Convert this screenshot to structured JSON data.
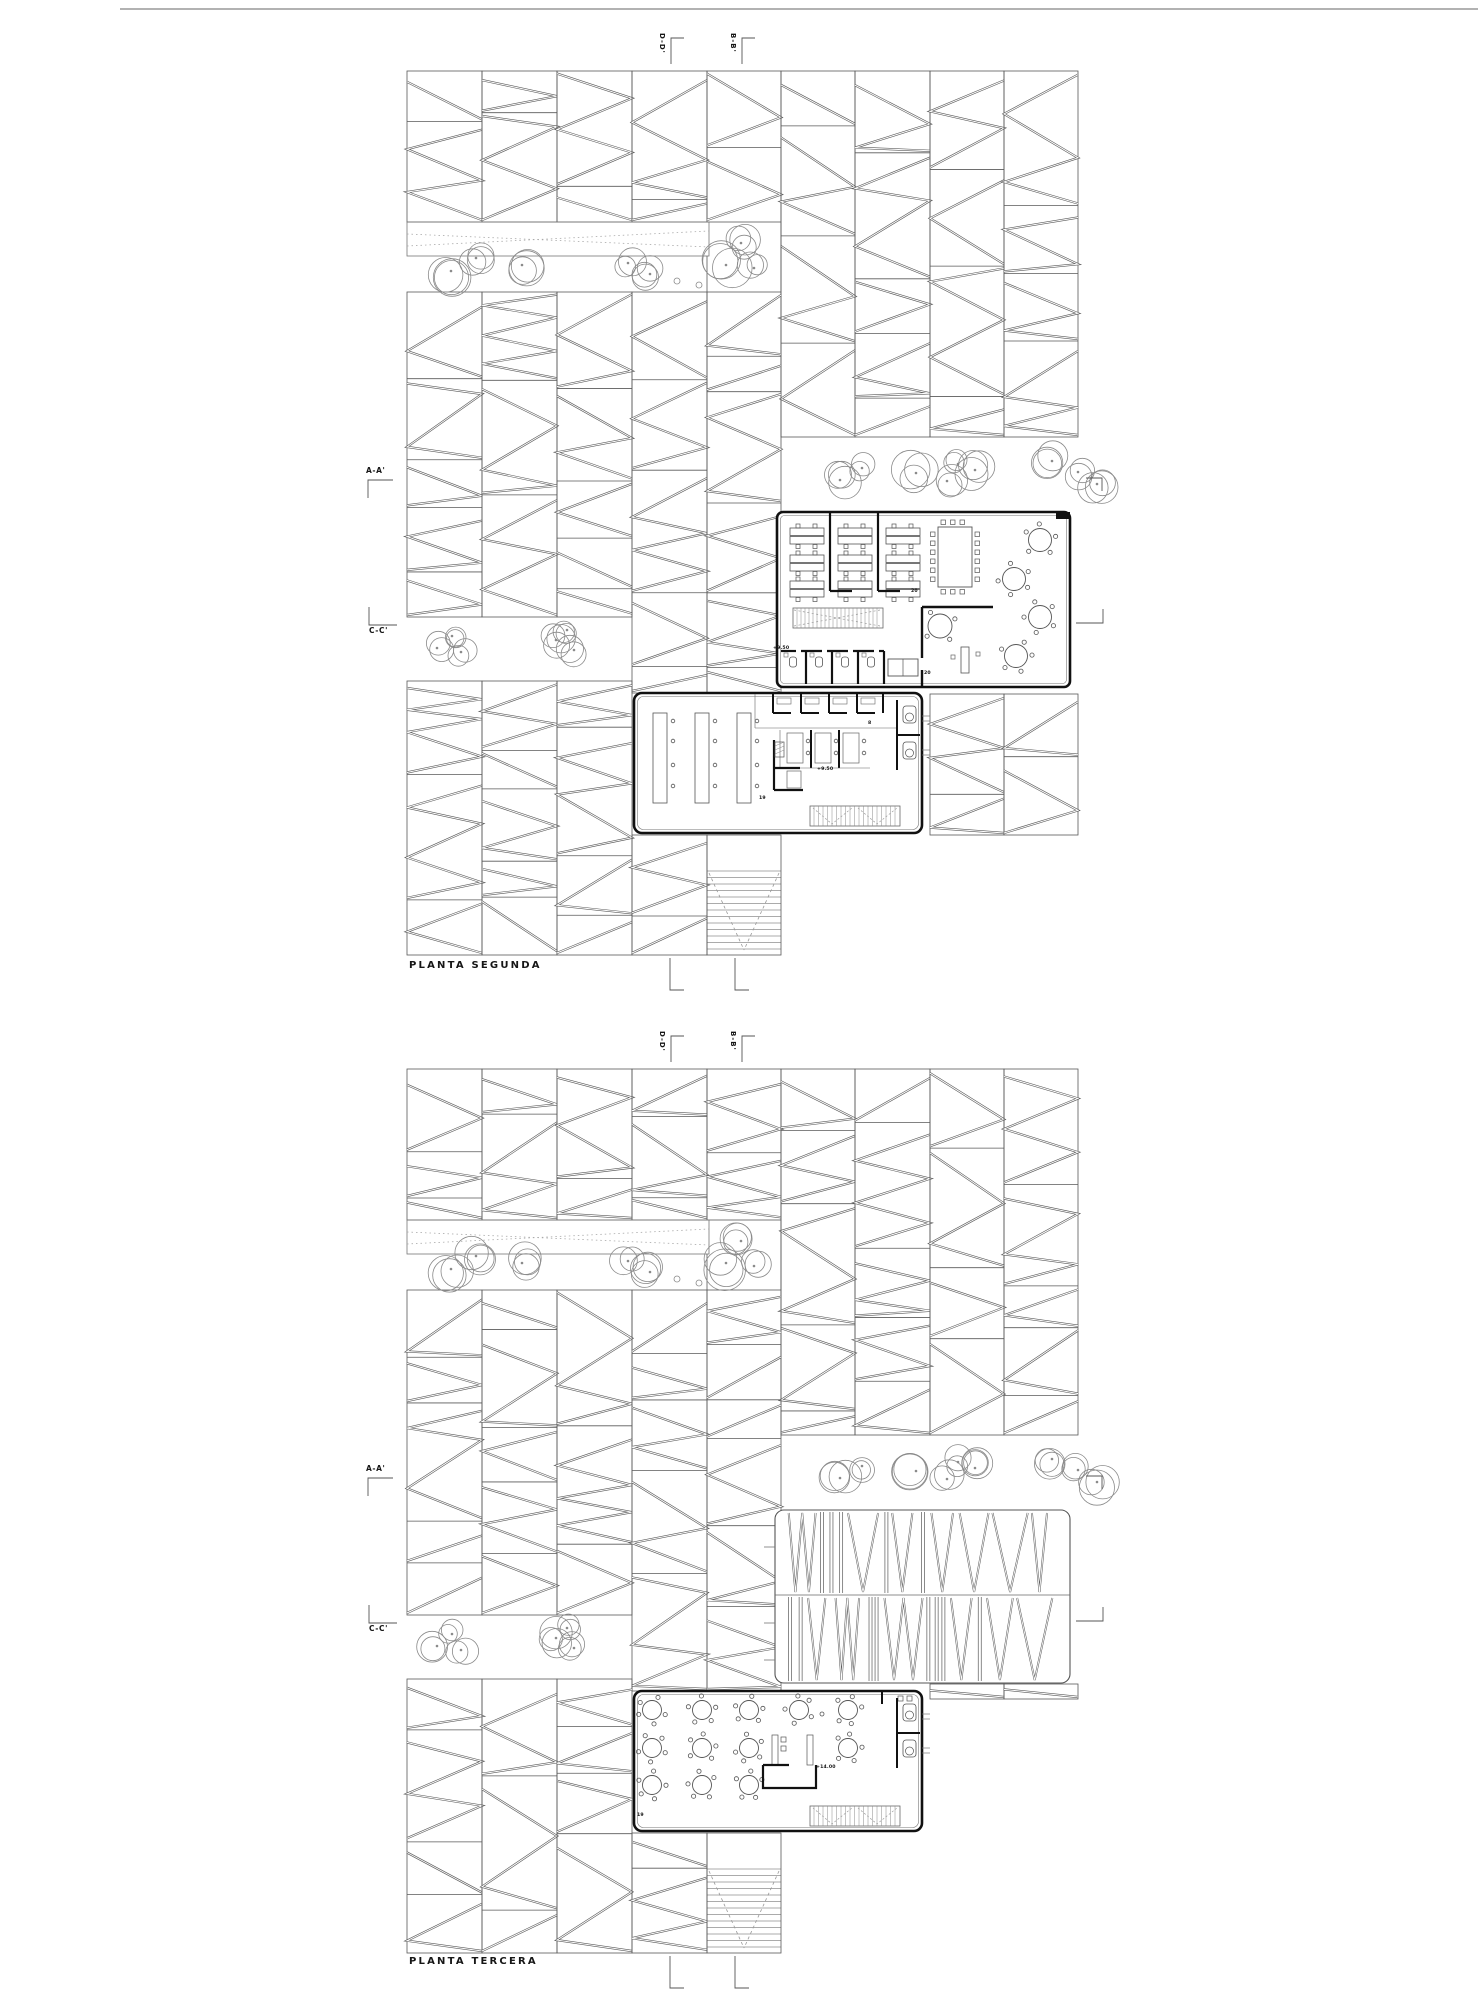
{
  "document_type": "architectural floor plan sheet",
  "page": {
    "background": "#ffffff",
    "line_color": "#595959",
    "wall_color": "#111111",
    "tree_color": "#8a8a8a",
    "canvas_width": 1480,
    "canvas_height": 2000
  },
  "labels": {
    "plan1_title": "PLANTA SEGUNDA",
    "plan2_title": "PLANTA TERCERA",
    "section_aa": "A-A'",
    "section_bb": "B-B'",
    "section_cc": "C-C'",
    "section_dd": "D-D'",
    "level_plus_9_50": "+9.50",
    "level_plus_14_00": "+14.00",
    "room_20": "20",
    "room_19": "19",
    "room_8": "8"
  },
  "plans": [
    {
      "name": "PLANTA SEGUNDA",
      "buildings": [
        {
          "name": "office floor",
          "level": "+9.50",
          "room_number": "20",
          "workstation_clusters": 9,
          "conference_seats": 18,
          "lounge_round_tables": 5
        },
        {
          "name": "reading hall",
          "level": "+9.50",
          "room_number": "19",
          "long_tables": 3,
          "toilet_cells": 2
        }
      ],
      "site_features": [
        "louvered pergola strips",
        "trees",
        "ramp band with dotted guide lines",
        "exterior stair"
      ]
    },
    {
      "name": "PLANTA TERCERA",
      "buildings": [
        {
          "name": "louvered roof",
          "bands": 2
        },
        {
          "name": "cafeteria",
          "level": "+14.00",
          "room_number": "19",
          "round_tables": 12,
          "toilet_cells": 2
        }
      ],
      "site_features": [
        "louvered pergola strips",
        "trees",
        "ramp band with dotted guide lines",
        "exterior stair"
      ]
    }
  ],
  "section_markers": [
    {
      "label": "A-A'",
      "orientation": "horizontal"
    },
    {
      "label": "C-C'",
      "orientation": "horizontal"
    },
    {
      "label": "D-D'",
      "orientation": "vertical"
    },
    {
      "label": "B-B'",
      "orientation": "vertical"
    }
  ]
}
